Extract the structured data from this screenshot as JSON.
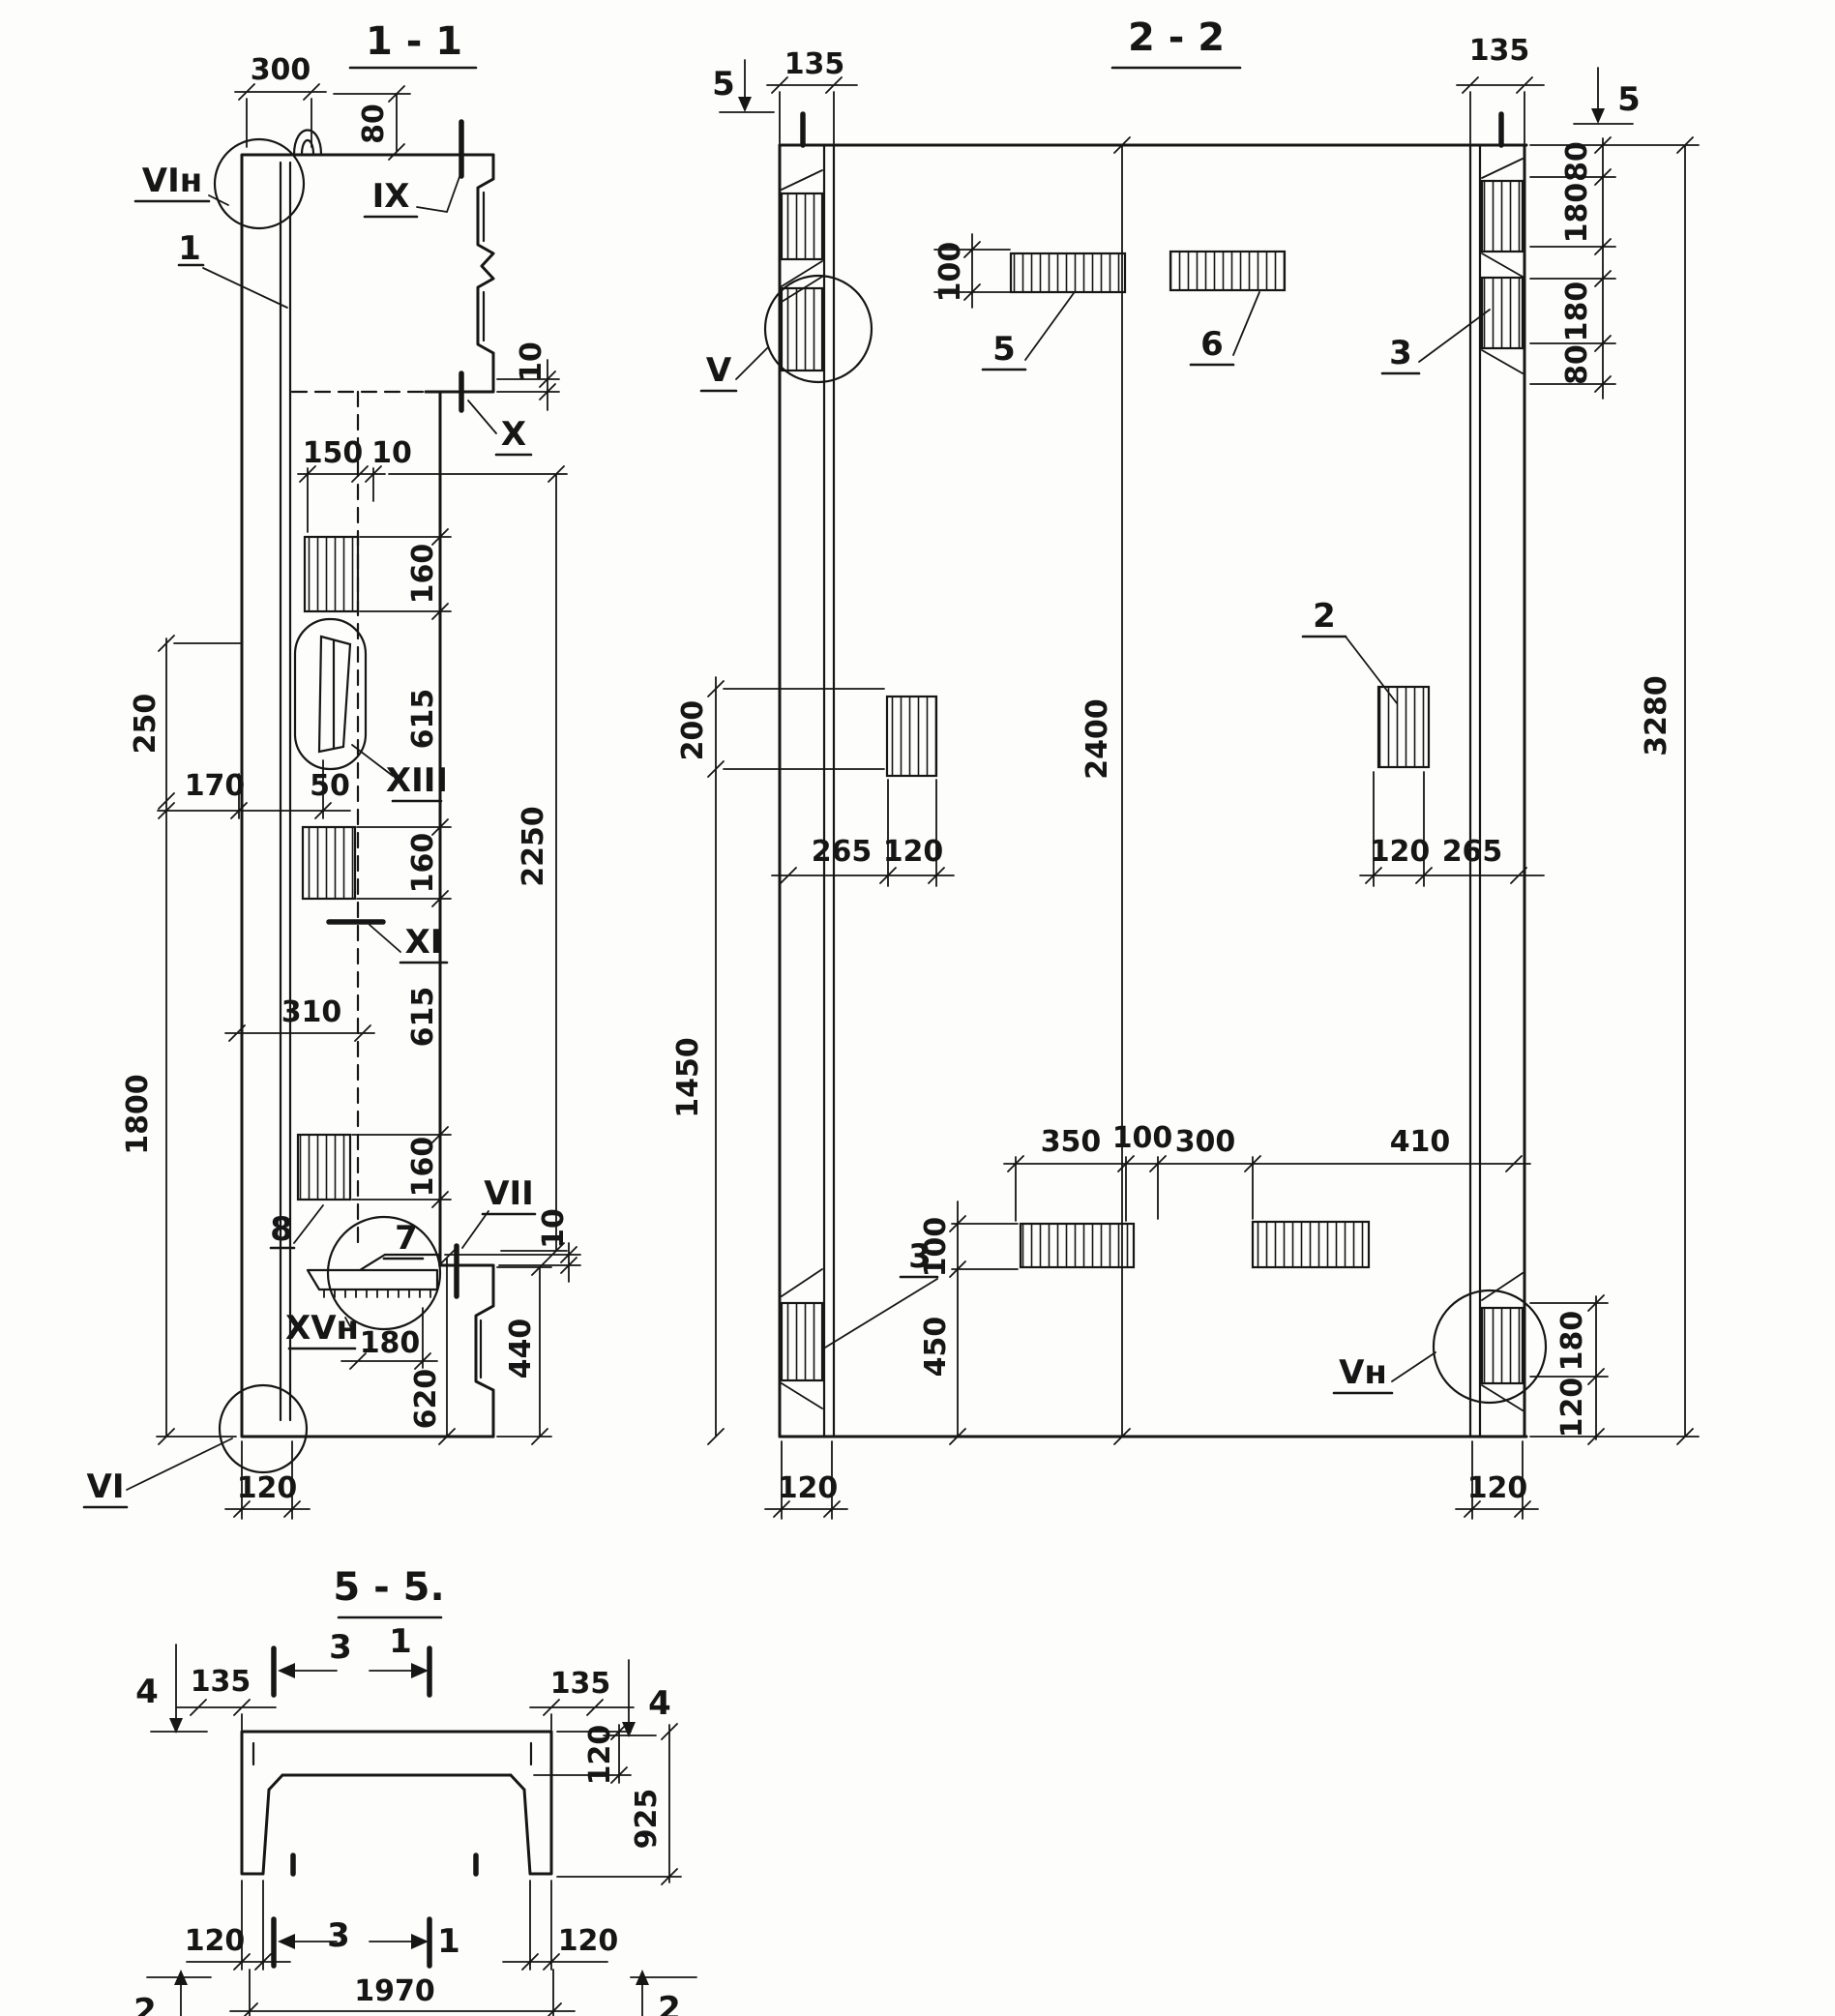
{
  "s11": {
    "title": "1 - 1",
    "labels": {
      "vi_n": "VIн",
      "ix": "IX",
      "x": "X",
      "xiii": "XIII",
      "xi": "XI",
      "vii": "VII",
      "xv_n": "XVн",
      "vi": "VI"
    },
    "callouts": {
      "c1": "1",
      "c7": "7",
      "c8": "8"
    },
    "dims": {
      "d300": "300",
      "d80": "80",
      "d10a": "10",
      "d150": "150",
      "d10b": "10",
      "d160a": "160",
      "d615a": "615",
      "d160b": "160",
      "d615b": "615",
      "d160c": "160",
      "d2250": "2250",
      "d250": "250",
      "d170": "170",
      "d50": "50",
      "d310": "310",
      "d1800": "1800",
      "d180": "180",
      "d620": "620",
      "d440": "440",
      "d10c": "10",
      "d120": "120"
    }
  },
  "s22": {
    "title": "2 - 2",
    "labels": {
      "v": "V",
      "v_n": "Vн"
    },
    "callouts": {
      "c2": "2",
      "c3t": "3",
      "c3b": "3",
      "c5": "5",
      "c6": "6"
    },
    "markers": {
      "m5l": "5",
      "m5r": "5"
    },
    "dims": {
      "d135l": "135",
      "d135r": "135",
      "d100t": "100",
      "d80t": "80",
      "d180a": "180",
      "d180b": "180",
      "d80b": "80",
      "d200": "200",
      "d2400": "2400",
      "d3280": "3280",
      "d265l": "265",
      "d120l": "120",
      "d120r": "120",
      "d265r": "265",
      "d1450": "1450",
      "d350": "350",
      "d100m": "100",
      "d300": "300",
      "d410": "410",
      "d100b": "100",
      "d450": "450",
      "d180c": "180",
      "d120c": "120",
      "d120bl": "120",
      "d120br": "120"
    }
  },
  "s55": {
    "title": "5 - 5.",
    "markers": {
      "m4l": "4",
      "m4r": "4",
      "m3t": "3",
      "m1t": "1",
      "m3b": "3",
      "m1b": "1",
      "m2l": "2",
      "m2r": "2"
    },
    "dims": {
      "d135l": "135",
      "d135r": "135",
      "d120t": "120",
      "d925": "925",
      "d120bl": "120",
      "d120br": "120",
      "d1970": "1970"
    }
  }
}
